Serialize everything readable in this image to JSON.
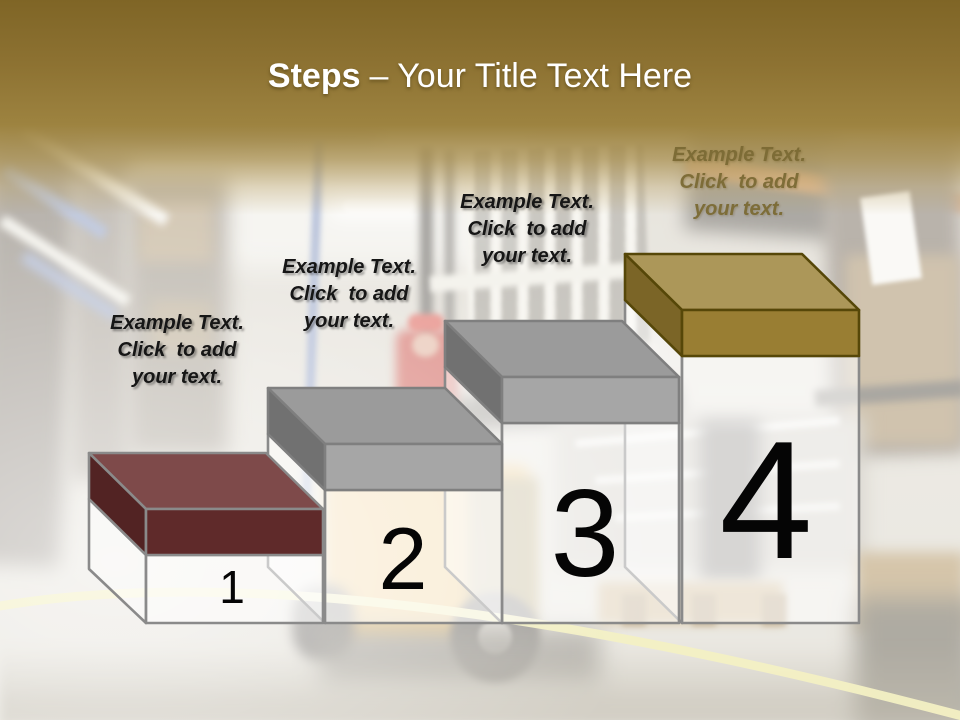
{
  "slide_title": {
    "emphasis": "Steps",
    "rest": "– Your Title Text Here"
  },
  "steps": [
    {
      "number": "1",
      "label": "Example Text.\nClick  to add\nyour text.",
      "cap_color": "#5F2A2A"
    },
    {
      "number": "2",
      "label": "Example Text.\nClick  to add\nyour text.",
      "cap_color": "#9B9B9B"
    },
    {
      "number": "3",
      "label": "Example Text.\nClick  to add\nyour text.",
      "cap_color": "#9B9B9B"
    },
    {
      "number": "4",
      "label": "Example Text.\nClick  to add\nyour text.",
      "cap_color": "#997E33"
    }
  ],
  "palette": {
    "header_gold_dark": "#7F6526",
    "header_gold_light": "#A98F4F",
    "title_color": "#FFFFFF",
    "maroon_top": "#7E4A4A",
    "maroon_front": "#5F2A2A",
    "gray_top": "#9B9B9B",
    "gray_front": "#A6A6A6",
    "gold_top": "#AC9759",
    "gold_front": "#997E33",
    "gold_outline": "#564708",
    "outline_gray": "#8A8A8A",
    "number_color": "#000000",
    "floor_line_yellow": "#E7E084"
  }
}
